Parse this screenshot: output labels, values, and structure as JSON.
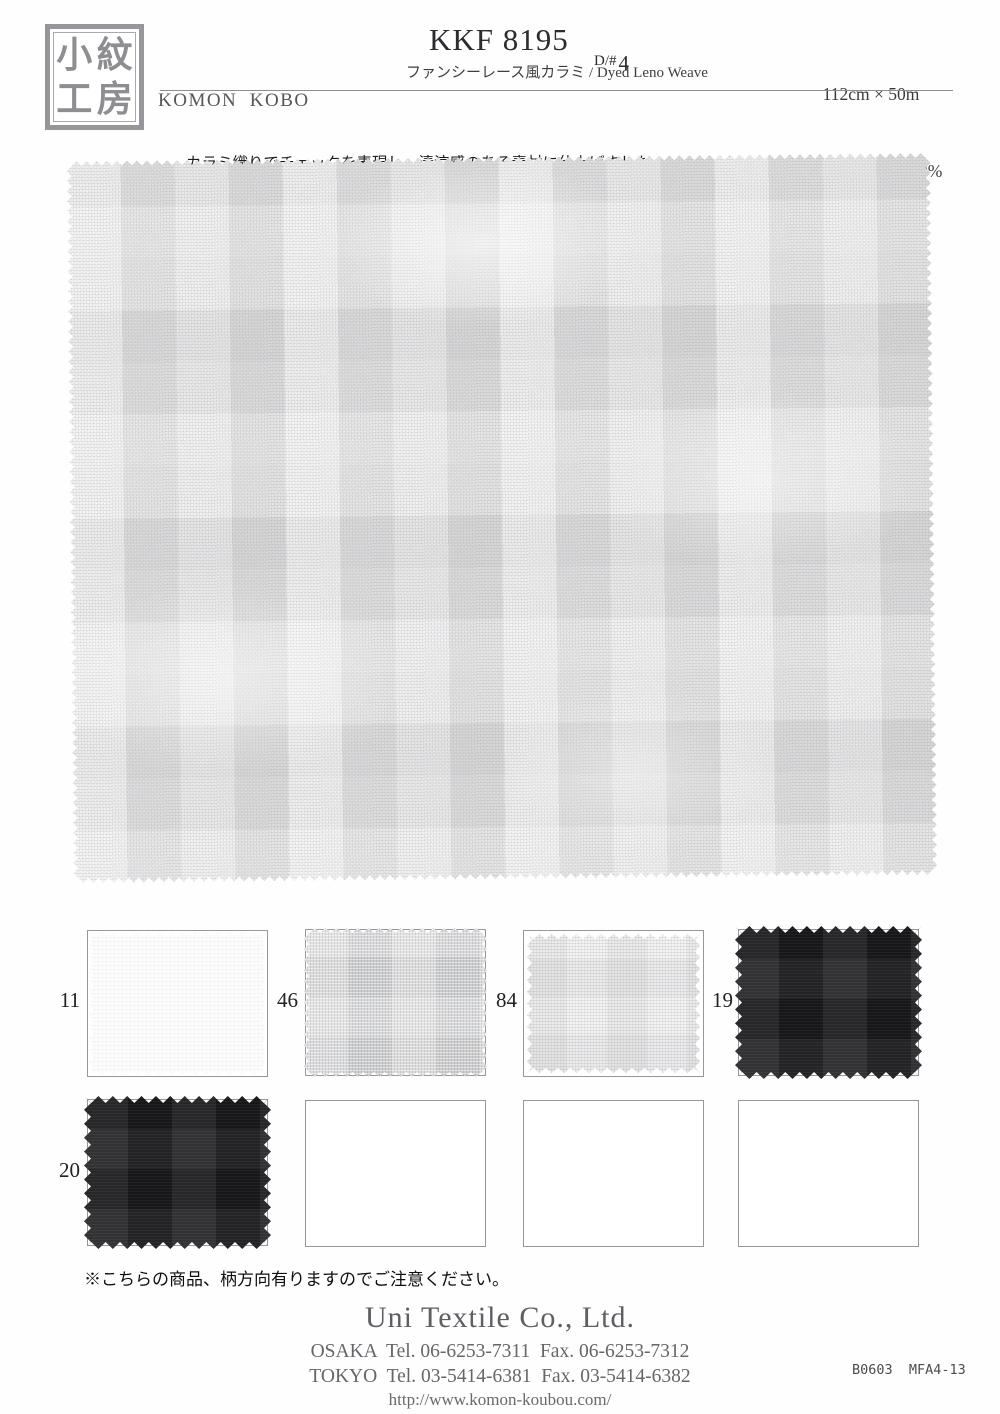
{
  "header": {
    "logo_chars": [
      "小",
      "紋",
      "工",
      "房"
    ],
    "brand_name": "KOMON  KOBO",
    "brand_origin": "MADE IN JAPAN",
    "product_code": "KKF 8195",
    "design_prefix": "D/#",
    "design_number": "4",
    "subtitle": "ファンシーレース風カラミ / Dyed Leno Weave",
    "width_length": "112cm × 50m",
    "material": "POLYESTER 100%"
  },
  "description": {
    "line1": "カラミ織りでチェックを表現し、清涼感のある素材に仕上げました。",
    "line2": "ドライタッチで天然ライクなナチュラルな風合いが特徴です。"
  },
  "swatches": {
    "row1": [
      {
        "number": "11",
        "color_name": "white"
      },
      {
        "number": "46",
        "color_name": "gray"
      },
      {
        "number": "84",
        "color_name": "light-gray"
      },
      {
        "number": "19",
        "color_name": "black"
      }
    ],
    "row2": [
      {
        "number": "20",
        "color_name": "black"
      }
    ]
  },
  "note": "※こちらの商品、柄方向有りますのでご注意ください。",
  "footer": {
    "company": "Uni Textile Co., Ltd.",
    "osaka_line": "OSAKA  Tel. 06-6253-7311  Fax. 06-6253-7312",
    "tokyo_line": "TOKYO  Tel. 03-5414-6381  Fax. 03-5414-6382",
    "website": "http://www.komon-koubou.com/",
    "doc_code": "B0603  MFA4-13"
  },
  "colors": {
    "accent_gray": "#97979b",
    "fabric_base": "#eeeeef",
    "swatch_black": "#17171a"
  }
}
